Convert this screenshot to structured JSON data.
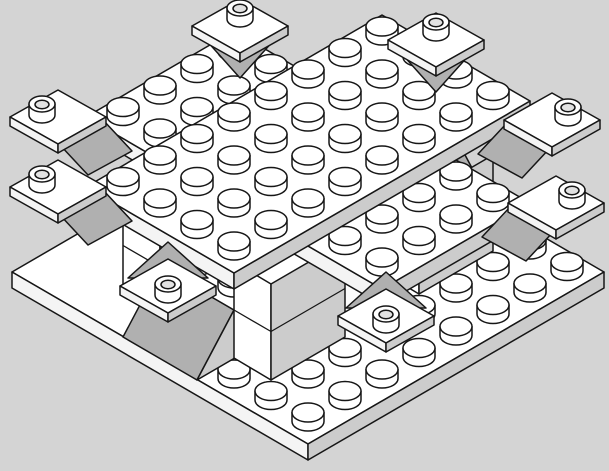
{
  "meta": {
    "description": "Isometric black-outline line drawing (building-instruction style) of a white LEGO assembly on a plain gray background. No text is visible in the image.",
    "canvas": {
      "width": 609,
      "height": 471
    }
  },
  "colors": {
    "background": "#d4d4d4",
    "outline": "#161616",
    "top_face": "#ffffff",
    "light_side_face": "#f4f4f4",
    "shaded_side_face": "#cccccc",
    "slope_face": "#b0b0b0",
    "open_stud_hole": "#e2e2e2",
    "translucent_outline": "#a9a9a9"
  },
  "model": {
    "style": "LEGO CAD / instruction line art",
    "parts_visible": [
      "8x8 base plate with studs",
      "lower deck plate 8x4 (cross arm, 2x4 stud patches exposed)",
      "upper deck plate 4x8 (32 studs on top)",
      "stacked 1x2 brick pillars supporting the deck",
      "45-degree slope bricks with gray sloped faces",
      "8 diagonal corner plates with open (hollow) studs at the deck corners",
      "2 translucent 1x1 round bricks in the center gap"
    ],
    "counts": {
      "regular_studs_visible": 70,
      "open_studs_visible": 8,
      "translucent_round_bricks": 2
    }
  }
}
